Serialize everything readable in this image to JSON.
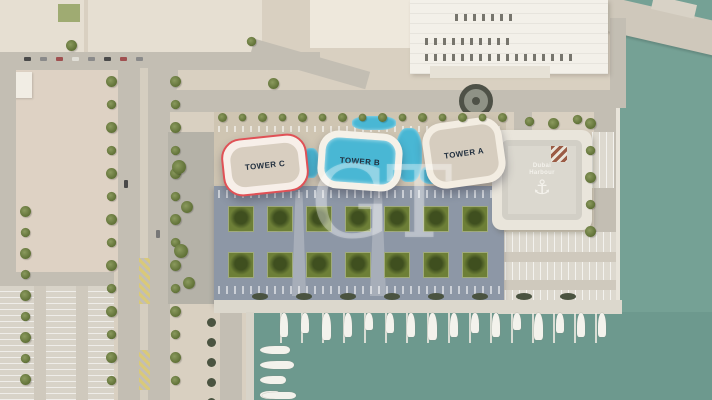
{
  "towers": [
    {
      "name": "tower-a",
      "label": "TOWER A",
      "highlighted": false
    },
    {
      "name": "tower-b",
      "label": "TOWER B",
      "highlighted": false
    },
    {
      "name": "tower-c",
      "label": "TOWER C",
      "highlighted": true
    }
  ],
  "rooftop_logo": {
    "line1": "Dubai",
    "line2": "Harbour",
    "icon": "anchor-icon"
  },
  "icons": {
    "anchor": "⚓"
  },
  "watermark": {
    "text": "GT"
  },
  "podium": {
    "garden_rows": 2,
    "gardens_per_row": 7
  },
  "marina": {
    "boats_top": 16,
    "boats_left": 4
  },
  "palette": {
    "land_beige": "#d9d0c1",
    "water_teal": "#75a195",
    "marina_teal": "#6d998e",
    "podium_slate": "#8d97a6",
    "garden_green": "#6d7f37",
    "pool_cyan": "#49b7d4",
    "tower_white": "#f5efe6",
    "tower_c_outline_red": "#e05156",
    "road_grey": "#c3beb3",
    "pier_light": "#dcd8cd",
    "tree_olive": "#72823f",
    "boat_white": "#f3f2ec"
  }
}
